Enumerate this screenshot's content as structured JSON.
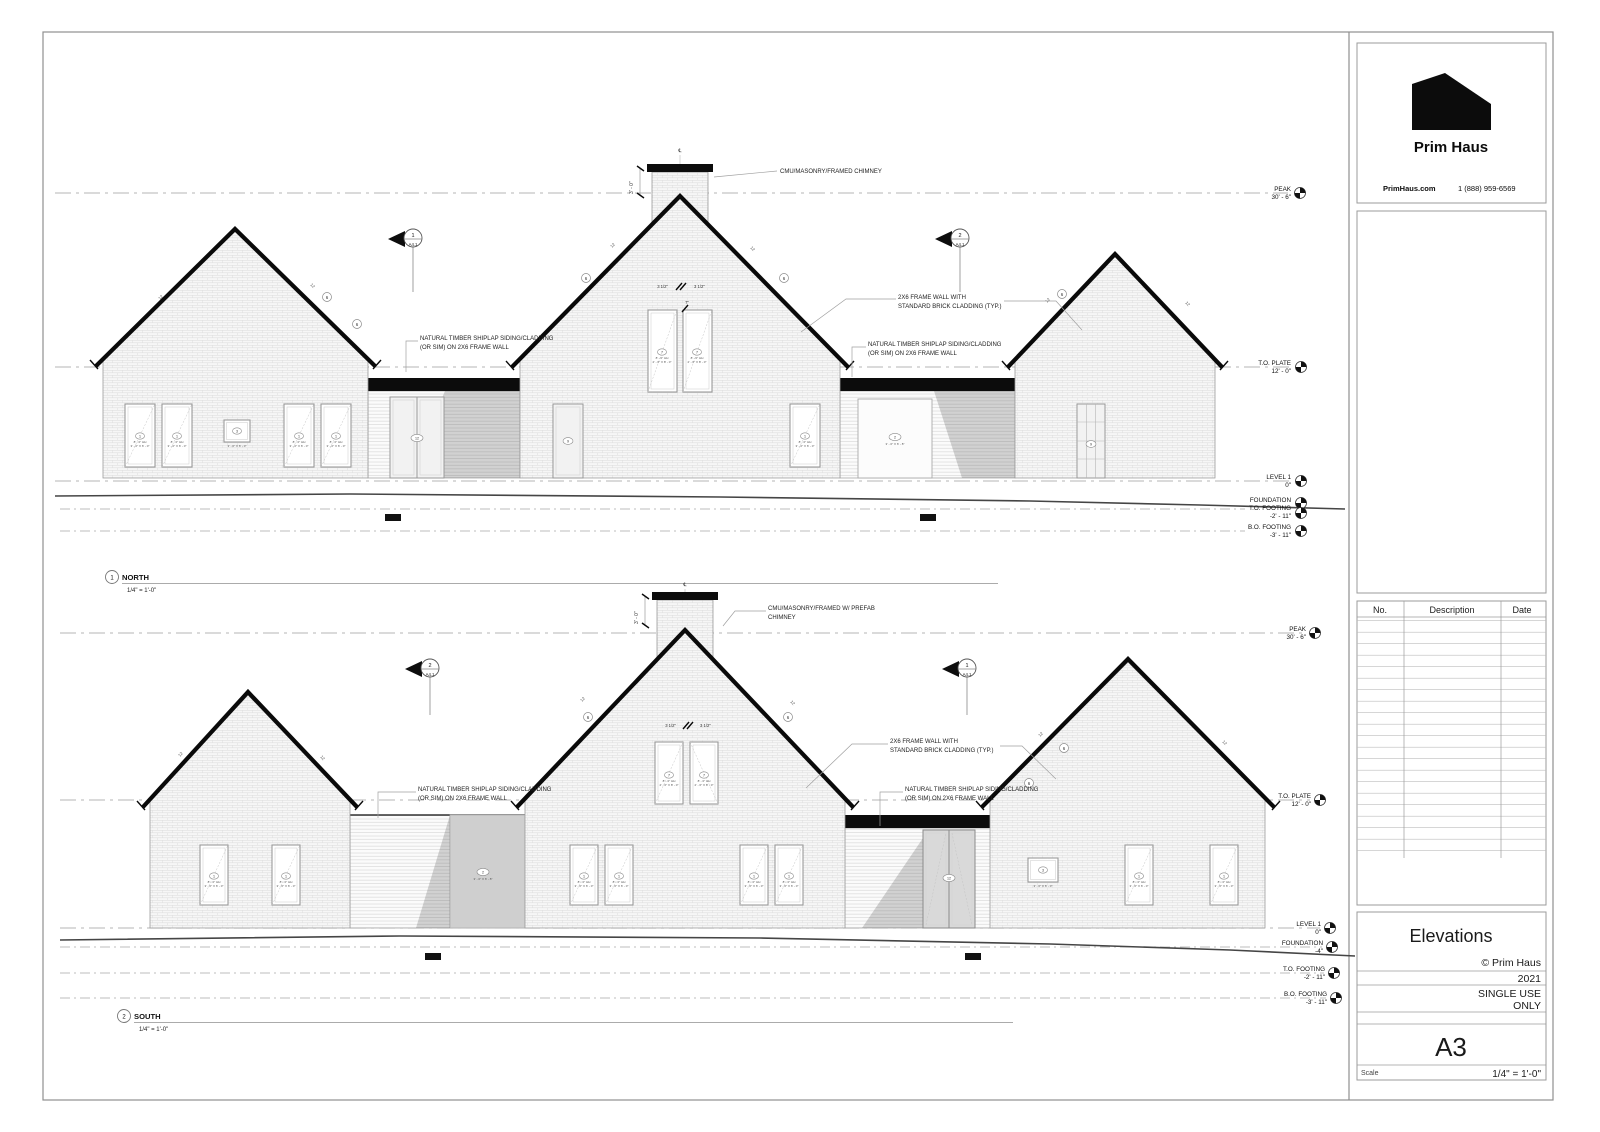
{
  "brand": {
    "name": "Prim Haus",
    "website": "PrimHaus.com",
    "phone": "1 (888) 959-6569"
  },
  "revisions": {
    "col_no": "No.",
    "col_description": "Description",
    "col_date": "Date"
  },
  "titleblock": {
    "sheet_title": "Elevations",
    "copyright": "© Prim Haus",
    "year": "2021",
    "usage1": "SINGLE USE",
    "usage2": "ONLY",
    "sheet_number": "A3",
    "scale_label": "Scale",
    "scale_value": "1/4\" = 1'-0\""
  },
  "views": {
    "north": {
      "num": "1",
      "name": "NORTH",
      "scale": "1/4\" = 1'-0\""
    },
    "south": {
      "num": "2",
      "name": "SOUTH",
      "scale": "1/4\" = 1'-0\""
    }
  },
  "levels": {
    "peak": {
      "name": "PEAK",
      "value": "30' - 6\""
    },
    "plate": {
      "name": "T.O. PLATE",
      "value": "12' - 0\""
    },
    "level1": {
      "name": "LEVEL 1",
      "value": "0\""
    },
    "foundation": {
      "name": "FOUNDATION",
      "value": "-4\""
    },
    "tofooting": {
      "name": "T.O. FOOTING",
      "value": "-2' - 11\""
    },
    "bofooting": {
      "name": "B.O. FOOTING",
      "value": "-3' - 11\""
    }
  },
  "notes": {
    "chimney_n": "CMU/MASONRY/FRAMED CHIMNEY",
    "chimney_s1": "CMU/MASONRY/FRAMED W/ PREFAB",
    "chimney_s2": "CHIMNEY",
    "framewall1": "2X6 FRAME WALL WITH",
    "framewall2": "STANDARD BRICK CLADDING (TYP.)",
    "shiplap1": "NATURAL TIMBER SHIPLAP SIDING/CLADDING",
    "shiplap2": "(OR SIM) ON 2X6 FRAME WALL"
  },
  "dims": {
    "chimney_h": "3' - 0\"",
    "mullion": "3 1/2\"",
    "seven": "7\"",
    "centerline": "℄",
    "slope": "12"
  },
  "section_markers": {
    "s1": {
      "num": "1",
      "sheet": "A4.1"
    },
    "s2": {
      "num": "2",
      "sheet": "A4.1"
    }
  },
  "tags": {
    "t1": "1",
    "t2": "2",
    "t3": "3",
    "t6": "6",
    "t7": "7",
    "t9": "9",
    "t12": "12",
    "hh": "8' - 0\" HH",
    "size_a": "3' - 0\" X 6' - 0\"",
    "size_b": "2' - 6\" X 8' - 0\"",
    "size_c": "3' - 0\" X 6' - 8\""
  }
}
